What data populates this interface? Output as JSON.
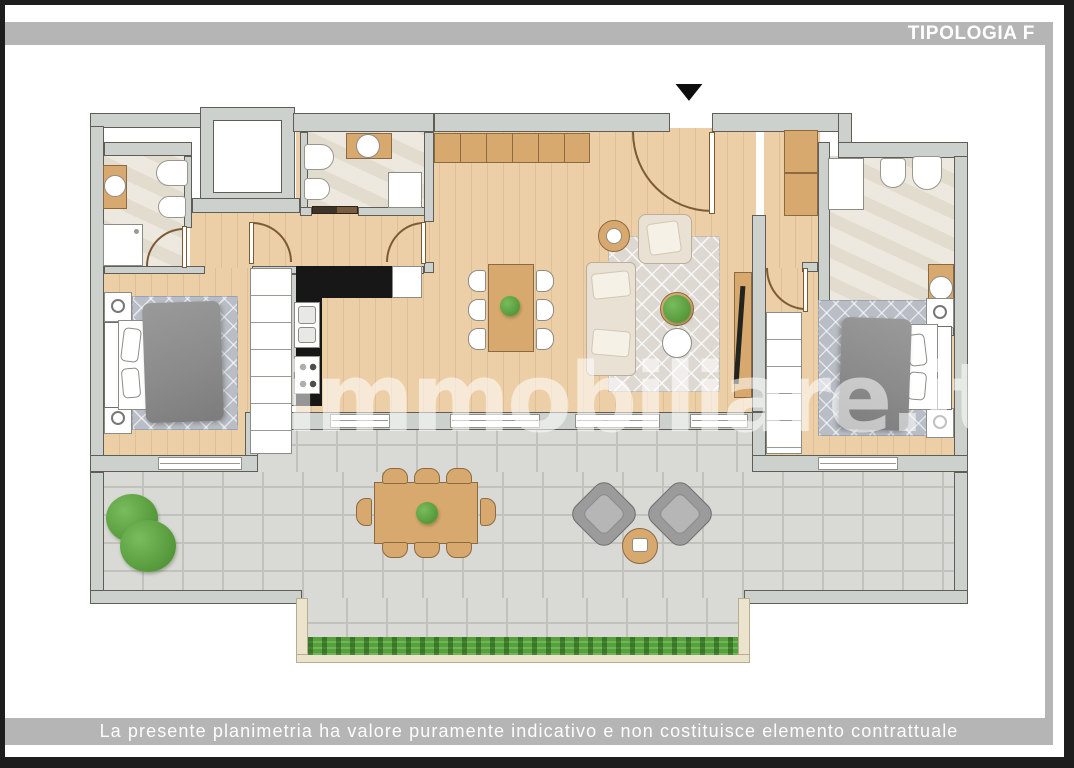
{
  "header": {
    "label": "TIPOLOGIA F"
  },
  "footer": {
    "disclaimer": "La presente planimetria ha valore puramente indicativo e non costituisce elemento contrattuale"
  },
  "watermark": {
    "text": "immobiliare.it"
  },
  "plan": {
    "entrance_marker": "▼"
  },
  "colors": {
    "bar_gray": "#b5b5b5",
    "frame_black": "#1d1d1d",
    "wall_fill": "#cdd1cd",
    "wall_line": "#5e5e56",
    "wood": "#eccfa6",
    "wood_dark": "#dfc096",
    "stone": "#eae5da",
    "paver": "#d9d9d5",
    "paver_line": "#c2c2bd",
    "furniture_wood": "#d8a96e",
    "counter_black": "#171717",
    "sofa": "#e9e1d4",
    "rug_living": "#ddd8d1",
    "rug_bedroom": "#b9bec6",
    "blanket": "#8b8b8b",
    "grass": "#55a13a",
    "plant_green": "#468a2e",
    "chair_gray": "#9b9b9b"
  }
}
